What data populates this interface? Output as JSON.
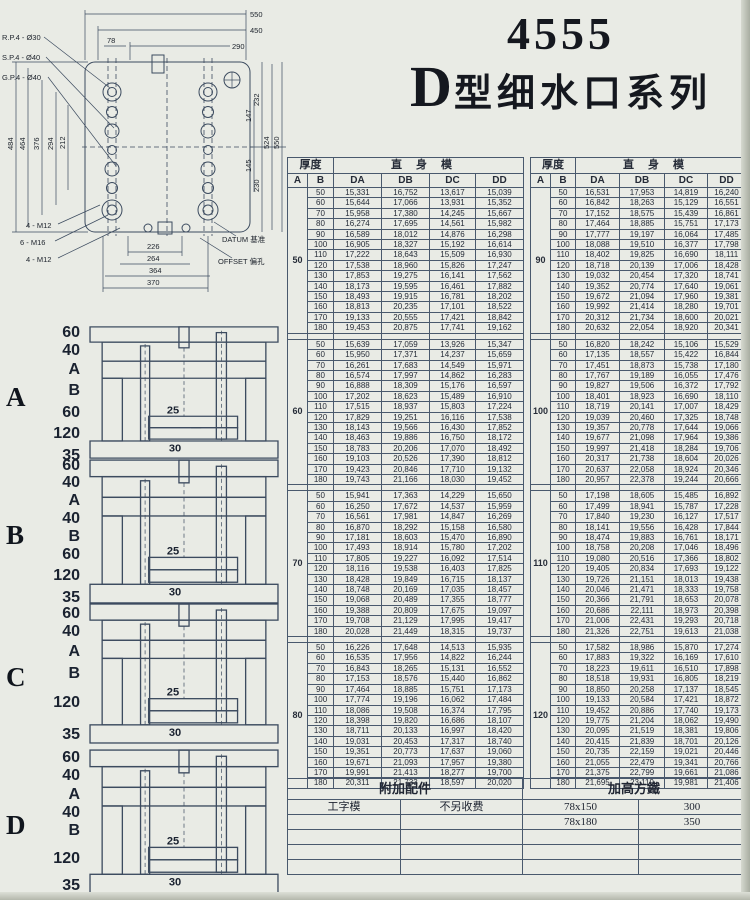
{
  "page": {
    "title_number": "4555",
    "title_d": "D",
    "title_series": "型细水口系列"
  },
  "drawing": {
    "leader_labels": [
      "R.P.4 - Ø30",
      "S.P.4 - Ø40",
      "G.P.4 - Ø40"
    ],
    "top_dims": [
      "550",
      "450",
      "290",
      "78"
    ],
    "left_dims": [
      "484",
      "464",
      "376",
      "294",
      "212"
    ],
    "right_dims": [
      "232",
      "147",
      "145",
      "230",
      "524",
      "550"
    ],
    "bottom_dims": [
      "226",
      "264",
      "364",
      "370"
    ],
    "bottom_labels": [
      "4 - M12",
      "6 - M16",
      "4 - M12"
    ],
    "datum_label": "DATUM 基准",
    "offset_label": "OFFSET 偏孔"
  },
  "tables": {
    "header": {
      "thickness": "厚度",
      "body": "直身模",
      "a": "A",
      "b": "B",
      "cols": [
        "DA",
        "DB",
        "DC",
        "DD"
      ]
    },
    "left_groups": [
      {
        "a": "50",
        "rows": [
          [
            "50",
            "15,331",
            "16,752",
            "13,617",
            "15,039"
          ],
          [
            "60",
            "15,644",
            "17,066",
            "13,931",
            "15,352"
          ],
          [
            "70",
            "15,958",
            "17,380",
            "14,245",
            "15,667"
          ],
          [
            "80",
            "16,274",
            "17,695",
            "14,561",
            "15,982"
          ],
          [
            "90",
            "16,589",
            "18,012",
            "14,876",
            "16,298"
          ],
          [
            "100",
            "16,905",
            "18,327",
            "15,192",
            "16,614"
          ],
          [
            "110",
            "17,222",
            "18,643",
            "15,509",
            "16,930"
          ],
          [
            "120",
            "17,538",
            "18,960",
            "15,826",
            "17,247"
          ],
          [
            "130",
            "17,853",
            "19,275",
            "16,141",
            "17,562"
          ],
          [
            "140",
            "18,173",
            "19,595",
            "16,461",
            "17,882"
          ],
          [
            "150",
            "18,493",
            "19,915",
            "16,781",
            "18,202"
          ],
          [
            "160",
            "18,813",
            "20,235",
            "17,101",
            "18,522"
          ],
          [
            "170",
            "19,133",
            "20,555",
            "17,421",
            "18,842"
          ],
          [
            "180",
            "19,453",
            "20,875",
            "17,741",
            "19,162"
          ]
        ]
      },
      {
        "a": "60",
        "rows": [
          [
            "50",
            "15,639",
            "17,059",
            "13,926",
            "15,347"
          ],
          [
            "60",
            "15,950",
            "17,371",
            "14,237",
            "15,659"
          ],
          [
            "70",
            "16,261",
            "17,683",
            "14,549",
            "15,971"
          ],
          [
            "80",
            "16,574",
            "17,997",
            "14,862",
            "16,283"
          ],
          [
            "90",
            "16,888",
            "18,309",
            "15,176",
            "16,597"
          ],
          [
            "100",
            "17,202",
            "18,623",
            "15,489",
            "16,910"
          ],
          [
            "110",
            "17,515",
            "18,937",
            "15,803",
            "17,224"
          ],
          [
            "120",
            "17,829",
            "19,251",
            "16,116",
            "17,538"
          ],
          [
            "130",
            "18,143",
            "19,566",
            "16,430",
            "17,852"
          ],
          [
            "140",
            "18,463",
            "19,886",
            "16,750",
            "18,172"
          ],
          [
            "150",
            "18,783",
            "20,206",
            "17,070",
            "18,492"
          ],
          [
            "160",
            "19,103",
            "20,526",
            "17,390",
            "18,812"
          ],
          [
            "170",
            "19,423",
            "20,846",
            "17,710",
            "19,132"
          ],
          [
            "180",
            "19,743",
            "21,166",
            "18,030",
            "19,452"
          ]
        ]
      },
      {
        "a": "70",
        "rows": [
          [
            "50",
            "15,941",
            "17,363",
            "14,229",
            "15,650"
          ],
          [
            "60",
            "16,250",
            "17,672",
            "14,537",
            "15,959"
          ],
          [
            "70",
            "16,561",
            "17,981",
            "14,847",
            "16,269"
          ],
          [
            "80",
            "16,870",
            "18,292",
            "15,158",
            "16,580"
          ],
          [
            "90",
            "17,181",
            "18,603",
            "15,470",
            "16,890"
          ],
          [
            "100",
            "17,493",
            "18,914",
            "15,780",
            "17,202"
          ],
          [
            "110",
            "17,805",
            "19,227",
            "16,092",
            "17,514"
          ],
          [
            "120",
            "18,116",
            "19,538",
            "16,403",
            "17,825"
          ],
          [
            "130",
            "18,428",
            "19,849",
            "16,715",
            "18,137"
          ],
          [
            "140",
            "18,748",
            "20,169",
            "17,035",
            "18,457"
          ],
          [
            "150",
            "19,068",
            "20,489",
            "17,355",
            "18,777"
          ],
          [
            "160",
            "19,388",
            "20,809",
            "17,675",
            "19,097"
          ],
          [
            "170",
            "19,708",
            "21,129",
            "17,995",
            "19,417"
          ],
          [
            "180",
            "20,028",
            "21,449",
            "18,315",
            "19,737"
          ]
        ]
      },
      {
        "a": "80",
        "rows": [
          [
            "50",
            "16,226",
            "17,648",
            "14,513",
            "15,935"
          ],
          [
            "60",
            "16,535",
            "17,956",
            "14,822",
            "16,244"
          ],
          [
            "70",
            "16,843",
            "18,265",
            "15,131",
            "16,552"
          ],
          [
            "80",
            "17,153",
            "18,576",
            "15,440",
            "16,862"
          ],
          [
            "90",
            "17,464",
            "18,885",
            "15,751",
            "17,173"
          ],
          [
            "100",
            "17,774",
            "19,196",
            "16,062",
            "17,484"
          ],
          [
            "110",
            "18,086",
            "19,508",
            "16,374",
            "17,795"
          ],
          [
            "120",
            "18,398",
            "19,820",
            "16,686",
            "18,107"
          ],
          [
            "130",
            "18,711",
            "20,133",
            "16,997",
            "18,420"
          ],
          [
            "140",
            "19,031",
            "20,453",
            "17,317",
            "18,740"
          ],
          [
            "150",
            "19,351",
            "20,773",
            "17,637",
            "19,060"
          ],
          [
            "160",
            "19,671",
            "21,093",
            "17,957",
            "19,380"
          ],
          [
            "170",
            "19,991",
            "21,413",
            "18,277",
            "19,700"
          ],
          [
            "180",
            "20,311",
            "21,733",
            "18,597",
            "20,020"
          ]
        ]
      }
    ],
    "right_groups": [
      {
        "a": "90",
        "rows": [
          [
            "50",
            "16,531",
            "17,953",
            "14,819",
            "16,240"
          ],
          [
            "60",
            "16,842",
            "18,263",
            "15,129",
            "16,551"
          ],
          [
            "70",
            "17,152",
            "18,575",
            "15,439",
            "16,861"
          ],
          [
            "80",
            "17,464",
            "18,885",
            "15,751",
            "17,173"
          ],
          [
            "90",
            "17,777",
            "19,197",
            "16,064",
            "17,485"
          ],
          [
            "100",
            "18,088",
            "19,510",
            "16,377",
            "17,798"
          ],
          [
            "110",
            "18,402",
            "19,825",
            "16,690",
            "18,111"
          ],
          [
            "120",
            "18,718",
            "20,139",
            "17,006",
            "18,428"
          ],
          [
            "130",
            "19,032",
            "20,454",
            "17,320",
            "18,741"
          ],
          [
            "140",
            "19,352",
            "20,774",
            "17,640",
            "19,061"
          ],
          [
            "150",
            "19,672",
            "21,094",
            "17,960",
            "19,381"
          ],
          [
            "160",
            "19,992",
            "21,414",
            "18,280",
            "19,701"
          ],
          [
            "170",
            "20,312",
            "21,734",
            "18,600",
            "20,021"
          ],
          [
            "180",
            "20,632",
            "22,054",
            "18,920",
            "20,341"
          ]
        ]
      },
      {
        "a": "100",
        "rows": [
          [
            "50",
            "16,820",
            "18,242",
            "15,106",
            "15,529"
          ],
          [
            "60",
            "17,135",
            "18,557",
            "15,422",
            "16,844"
          ],
          [
            "70",
            "17,451",
            "18,873",
            "15,738",
            "17,180"
          ],
          [
            "80",
            "17,767",
            "19,189",
            "16,055",
            "17,476"
          ],
          [
            "90",
            "19,827",
            "19,506",
            "16,372",
            "17,792"
          ],
          [
            "100",
            "18,401",
            "18,923",
            "16,690",
            "18,110"
          ],
          [
            "110",
            "18,719",
            "20,141",
            "17,007",
            "18,429"
          ],
          [
            "120",
            "19,039",
            "20,460",
            "17,325",
            "18,748"
          ],
          [
            "130",
            "19,357",
            "20,778",
            "17,644",
            "19,066"
          ],
          [
            "140",
            "19,677",
            "21,098",
            "17,964",
            "19,386"
          ],
          [
            "150",
            "19,997",
            "21,418",
            "18,284",
            "19,706"
          ],
          [
            "160",
            "20,317",
            "21,738",
            "18,604",
            "20,026"
          ],
          [
            "170",
            "20,637",
            "22,058",
            "18,924",
            "20,346"
          ],
          [
            "180",
            "20,957",
            "22,378",
            "19,244",
            "20,666"
          ]
        ]
      },
      {
        "a": "110",
        "rows": [
          [
            "50",
            "17,198",
            "18,605",
            "15,485",
            "16,892"
          ],
          [
            "60",
            "17,499",
            "18,941",
            "15,787",
            "17,228"
          ],
          [
            "70",
            "17,840",
            "19,230",
            "16,127",
            "17,517"
          ],
          [
            "80",
            "18,141",
            "19,556",
            "16,428",
            "17,844"
          ],
          [
            "90",
            "18,474",
            "19,883",
            "16,761",
            "18,171"
          ],
          [
            "100",
            "18,758",
            "20,208",
            "17,046",
            "18,496"
          ],
          [
            "110",
            "19,080",
            "20,516",
            "17,366",
            "18,802"
          ],
          [
            "120",
            "19,405",
            "20,834",
            "17,693",
            "19,122"
          ],
          [
            "130",
            "19,726",
            "21,151",
            "18,013",
            "19,438"
          ],
          [
            "140",
            "20,046",
            "21,471",
            "18,333",
            "19,758"
          ],
          [
            "150",
            "20,366",
            "21,791",
            "18,653",
            "20,078"
          ],
          [
            "160",
            "20,686",
            "22,111",
            "18,973",
            "20,398"
          ],
          [
            "170",
            "21,006",
            "22,431",
            "19,293",
            "20,718"
          ],
          [
            "180",
            "21,326",
            "22,751",
            "19,613",
            "21,038"
          ]
        ]
      },
      {
        "a": "120",
        "rows": [
          [
            "50",
            "17,582",
            "18,986",
            "15,870",
            "17,274"
          ],
          [
            "60",
            "17,883",
            "19,322",
            "16,169",
            "17,610"
          ],
          [
            "70",
            "18,223",
            "19,611",
            "16,510",
            "17,898"
          ],
          [
            "80",
            "18,518",
            "19,931",
            "16,805",
            "18,219"
          ],
          [
            "90",
            "18,850",
            "20,258",
            "17,137",
            "18,545"
          ],
          [
            "100",
            "19,133",
            "20,584",
            "17,421",
            "18,872"
          ],
          [
            "110",
            "19,452",
            "20,886",
            "17,740",
            "19,173"
          ],
          [
            "120",
            "19,775",
            "21,204",
            "18,062",
            "19,490"
          ],
          [
            "130",
            "20,095",
            "21,519",
            "18,381",
            "19,806"
          ],
          [
            "140",
            "20,415",
            "21,839",
            "18,701",
            "20,126"
          ],
          [
            "150",
            "20,735",
            "22,159",
            "19,021",
            "20,446"
          ],
          [
            "160",
            "21,055",
            "22,479",
            "19,341",
            "20,766"
          ],
          [
            "170",
            "21,375",
            "22,799",
            "19,661",
            "21,086"
          ],
          [
            "180",
            "21,695",
            "23,119",
            "19,981",
            "21,406"
          ]
        ]
      }
    ]
  },
  "diagrams": [
    {
      "letter": "A",
      "top": 325,
      "height": 135,
      "labels": [
        {
          "t": "60",
          "y": 0
        },
        {
          "t": "40",
          "y": 18
        },
        {
          "t": "A",
          "y": 37
        },
        {
          "t": "B",
          "y": 58
        },
        {
          "t": "60",
          "y": 80
        },
        {
          "t": "120",
          "y": 101
        },
        {
          "t": "35",
          "y": 123
        }
      ],
      "inner": [
        "25",
        "30"
      ]
    },
    {
      "letter": "B",
      "top": 458,
      "height": 147,
      "labels": [
        {
          "t": "60",
          "y": 0
        },
        {
          "t": "40",
          "y": 17
        },
        {
          "t": "A",
          "y": 35
        },
        {
          "t": "40",
          "y": 53
        },
        {
          "t": "B",
          "y": 71
        },
        {
          "t": "60",
          "y": 89
        },
        {
          "t": "120",
          "y": 110
        },
        {
          "t": "35",
          "y": 132
        }
      ],
      "inner": [
        "25",
        "30"
      ]
    },
    {
      "letter": "C",
      "top": 602,
      "height": 143,
      "labels": [
        {
          "t": "60",
          "y": 4
        },
        {
          "t": "40",
          "y": 22
        },
        {
          "t": "A",
          "y": 42
        },
        {
          "t": "B",
          "y": 64
        },
        {
          "t": "120",
          "y": 93
        },
        {
          "t": "35",
          "y": 125
        }
      ],
      "inner": [
        "25",
        "30"
      ]
    },
    {
      "letter": "D",
      "top": 748,
      "height": 147,
      "labels": [
        {
          "t": "60",
          "y": 2
        },
        {
          "t": "40",
          "y": 20
        },
        {
          "t": "A",
          "y": 39
        },
        {
          "t": "40",
          "y": 57
        },
        {
          "t": "B",
          "y": 75
        },
        {
          "t": "120",
          "y": 103
        },
        {
          "t": "35",
          "y": 130
        }
      ],
      "inner": [
        "25",
        "30"
      ]
    }
  ],
  "bottom_table": {
    "header_left": "附加配件",
    "header_right": "加高方鐵",
    "rows": [
      [
        "工字模",
        "不另收费",
        "78x150",
        "300"
      ],
      [
        "",
        "",
        "78x180",
        "350"
      ],
      [
        "",
        "",
        "",
        ""
      ],
      [
        "",
        "",
        "",
        ""
      ],
      [
        "",
        "",
        "",
        ""
      ]
    ]
  }
}
